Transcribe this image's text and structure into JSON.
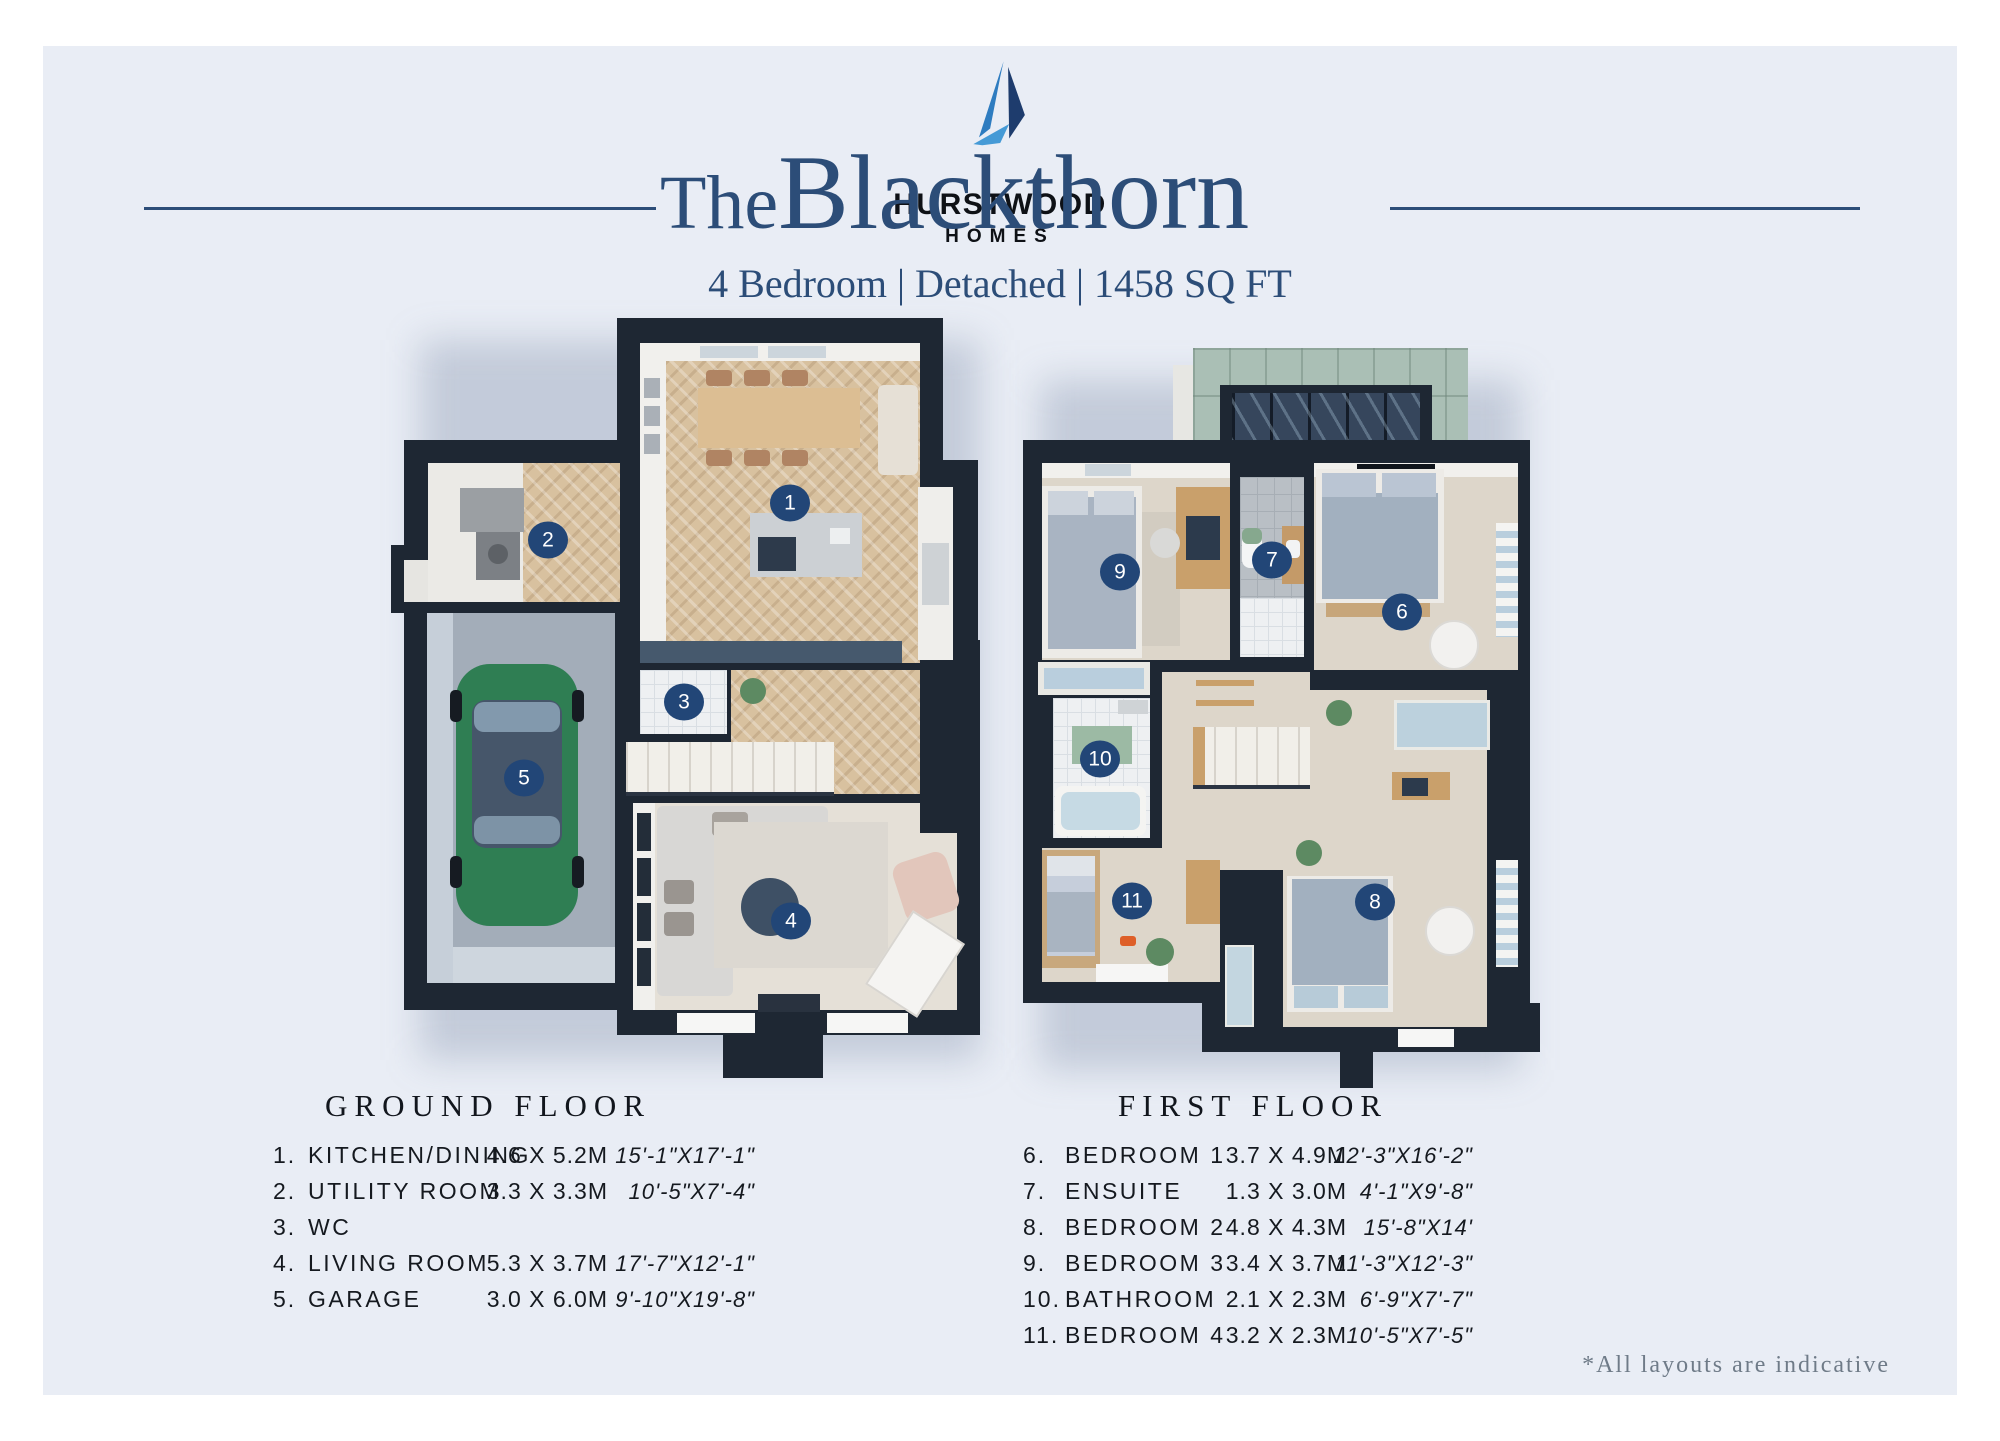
{
  "brand": {
    "name": "HURSTWOOD",
    "sub": "HOMES"
  },
  "title": {
    "prefix": "The",
    "name": "Blackthorn"
  },
  "subtitle": "4 Bedroom | Detached | 1458 SQ FT",
  "plans": [
    {
      "heading": "GROUND FLOOR",
      "rooms": [
        {
          "num": "1.",
          "name": "KITCHEN/DINING",
          "metric": "4.6 X 5.2M",
          "imperial": "15'-1\"X17'-1\""
        },
        {
          "num": "2.",
          "name": "UTILITY ROOM",
          "metric": "3.3 X 3.3M",
          "imperial": "10'-5\"X7'-4\""
        },
        {
          "num": "3.",
          "name": "WC",
          "metric": "",
          "imperial": ""
        },
        {
          "num": "4.",
          "name": "LIVING ROOM",
          "metric": "5.3 X 3.7M",
          "imperial": "17'-7\"X12'-1\""
        },
        {
          "num": "5.",
          "name": "GARAGE",
          "metric": "3.0 X 6.0M",
          "imperial": "9'-10\"X19'-8\""
        }
      ]
    },
    {
      "heading": "FIRST FLOOR",
      "rooms": [
        {
          "num": "6.",
          "name": "BEDROOM 1",
          "metric": "3.7 X 4.9M",
          "imperial": "12'-3\"X16'-2\""
        },
        {
          "num": "7.",
          "name": "ENSUITE",
          "metric": "1.3 X 3.0M",
          "imperial": "4'-1\"X9'-8\""
        },
        {
          "num": "8.",
          "name": "BEDROOM 2",
          "metric": "4.8 X 4.3M",
          "imperial": "15'-8\"X14'"
        },
        {
          "num": "9.",
          "name": "BEDROOM 3",
          "metric": "3.4 X 3.7M",
          "imperial": "11'-3\"X12'-3\""
        },
        {
          "num": "10.",
          "name": "BATHROOM",
          "metric": "2.1 X 2.3M",
          "imperial": "6'-9\"X7'-7\""
        },
        {
          "num": "11.",
          "name": "BEDROOM 4",
          "metric": "3.2 X 2.3M",
          "imperial": "10'-5\"X7'-5\""
        }
      ]
    }
  ],
  "markers": {
    "m1": "1",
    "m2": "2",
    "m3": "3",
    "m4": "4",
    "m5": "5",
    "m6": "6",
    "m7": "7",
    "m8": "8",
    "m9": "9",
    "m10": "10",
    "m11": "11"
  },
  "footnote": "*All layouts are indicative",
  "colors": {
    "accent_navy": "#2c4d78",
    "wall": "#1e2733",
    "marker": "#224677",
    "panel": "#e9edf5",
    "roof_green": "#aabfb5",
    "car_green": "#2f7e53"
  }
}
